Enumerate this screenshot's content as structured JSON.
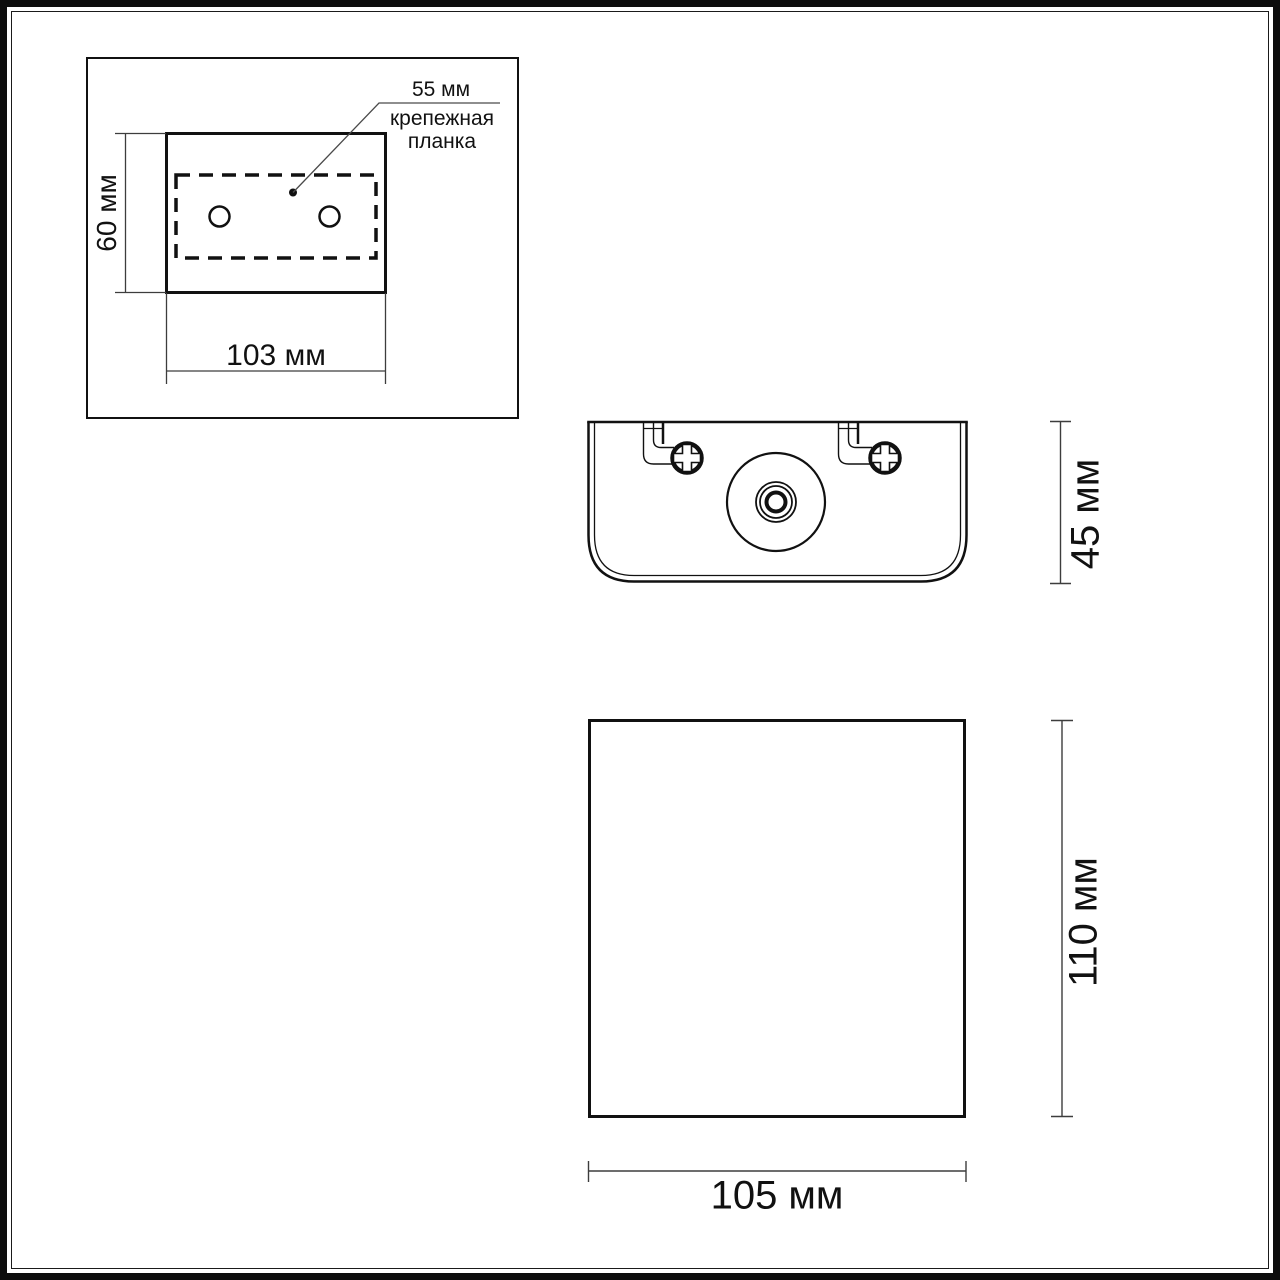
{
  "labels": {
    "plate_width": "55 мм",
    "plate_callout": "крепежная планка",
    "rear_height": "60 мм",
    "rear_width": "103 мм",
    "side_depth": "45 мм",
    "front_height": "110 мм",
    "front_width": "105 мм"
  },
  "colors": {
    "background": "#ffffff",
    "object_line": "#111111",
    "dimension_line": "#3d3d3d",
    "frame": "#0d0d0d"
  }
}
